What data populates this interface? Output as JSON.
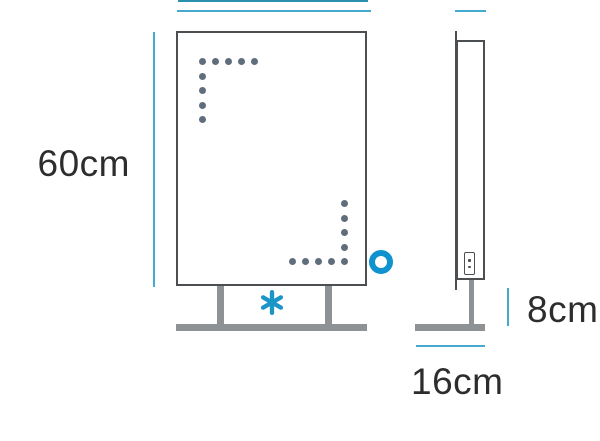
{
  "diagram": {
    "height_label": "60cm",
    "leg_height_label": "8cm",
    "depth_label": "16cm",
    "icons": {
      "asterisk_marker": "*",
      "circle_marker": "o",
      "switch": "power-switch"
    },
    "front_view": {
      "dots_top_left": {
        "horizontal": 5,
        "vertical": 4
      },
      "dots_bottom_right": {
        "horizontal": 5,
        "vertical": 4
      }
    },
    "colors": {
      "dimension_cyan": "#45AACD",
      "crop_line_teal": "#2B8FAE",
      "marker_blue": "#0E93CE",
      "outline_dark": "#4B4F52",
      "hardware_gray": "#8E9295",
      "dot_slate": "#5F6D7C",
      "text_dark": "#2D2D2D"
    }
  }
}
